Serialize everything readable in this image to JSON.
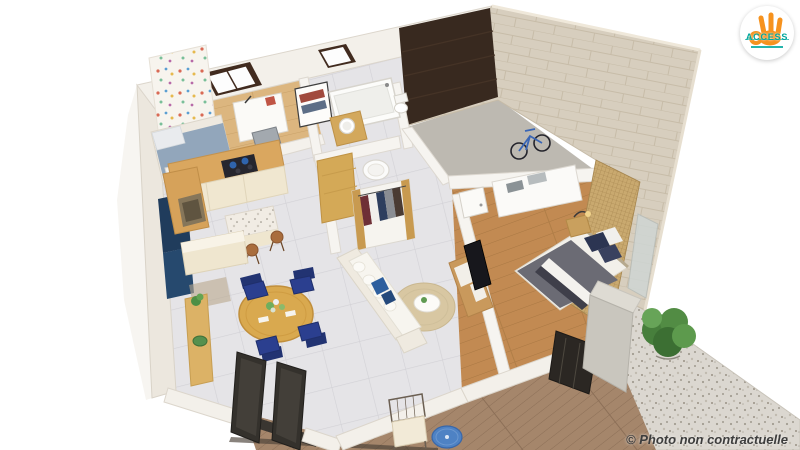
{
  "logo": {
    "brand": "ACCESS",
    "hand_color": "#F6921E",
    "text_color": "#00A79D",
    "circle_color": "#FFFFFF"
  },
  "caption": {
    "text": "© Photo non contractuelle",
    "color": "#3D3D3D"
  },
  "scene": {
    "type": "isometric-3d-floorplan-render",
    "rooms": [
      "kids-bedroom",
      "kitchen",
      "dining-area",
      "living-room",
      "bathroom",
      "dressing",
      "hallway",
      "garage",
      "master-bedroom",
      "wood-deck",
      "gravel-patio"
    ],
    "palette": {
      "wall_white": "#F3F0EA",
      "wall_stone": "#D7CEBE",
      "tile_floor": "#E5E4E7",
      "wood_light": "#DCB67F",
      "wood_dark": "#C28A52",
      "deck_wood": "#A5866B",
      "gravel": "#DBD7D0",
      "kitchen_wood": "#DAA75F",
      "cabinet_cream": "#EFE6CF",
      "accent_navy": "#2B3F8F",
      "accent_blue_table": "#4E82C4",
      "sofa_white": "#F1EDE4",
      "rug_beige": "#D8C7A2",
      "garage_door_brown": "#38291F",
      "garage_floor": "#BDB9B1",
      "bed_gray": "#6B6B74",
      "screen_gold": "#C9A96F",
      "plant_green": "#477F3C"
    }
  }
}
